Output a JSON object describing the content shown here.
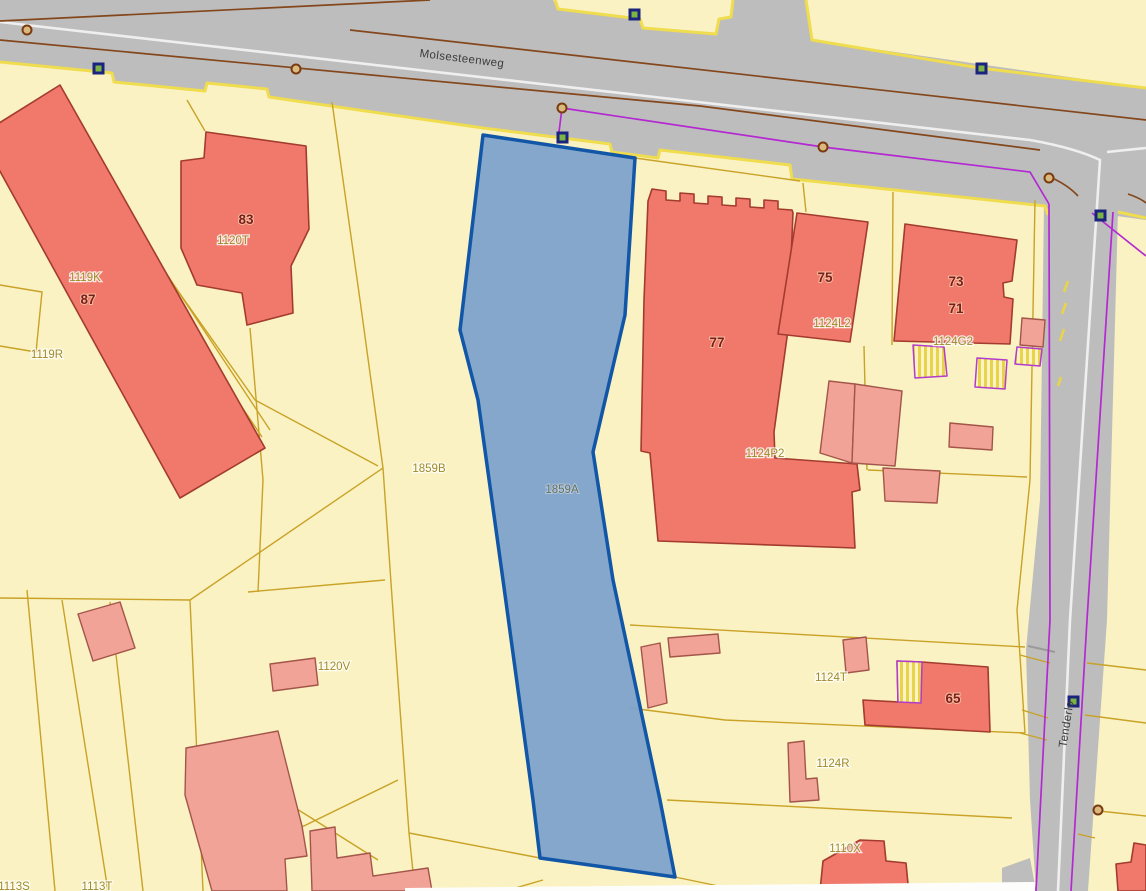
{
  "map": {
    "streets": {
      "main_road": "Molsesteenweg",
      "side_road": "Tenderlo"
    },
    "selected_parcel": {
      "id": "1859A"
    },
    "parcels": {
      "p1119K": "1119K",
      "p1119R": "1119R",
      "p1120T": "1120T",
      "p1859B": "1859B",
      "p1859A": "1859A",
      "p1124L2": "1124L2",
      "p1124G2": "1124G2",
      "p1124P2": "1124P2",
      "p1120V": "1120V",
      "p1124T": "1124T",
      "p1124R": "1124R",
      "p1110X": "1110X",
      "p1113T": "1113T",
      "p1113S": "1113S"
    },
    "house_numbers": {
      "n83": "83",
      "n87": "87",
      "n75": "75",
      "n77": "77",
      "n73": "73",
      "n71": "71",
      "n65": "65"
    },
    "colors": {
      "background": "#FAF2C2",
      "road": "#BDBDBD",
      "selected_fill": "#7DA2CB",
      "selected_stroke": "#1156A7",
      "building": "#F0796C",
      "building_stroke": "#A33B2E",
      "annex": "#F2A398",
      "parcel_line": "#C9A227",
      "road_edge_yellow": "#EFDC4F",
      "utility_purple": "#B428D2",
      "road_axis_brown": "#84471C",
      "marker_green": "#7CB342",
      "marker_navy": "#1A237E",
      "boundary_point_brown": "#7A3A10",
      "label_number": "#7B1D1D",
      "label_parcel": "#A08A28",
      "label_selected": "#68705C",
      "street_name": "#3C3C3C"
    }
  }
}
